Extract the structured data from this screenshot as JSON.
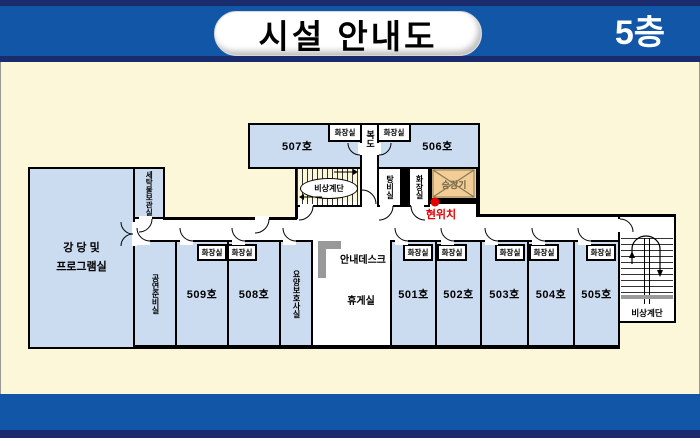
{
  "header": {
    "title": "시설 안내도",
    "floor": "5층"
  },
  "plan": {
    "labels": {
      "auditorium1": "강 당 및",
      "auditorium2": "프로그램실",
      "laundry": "세탁물보관실",
      "room507": "507호",
      "room506": "506호",
      "corridor": "복도",
      "toilet": "화장실",
      "stairs": "비상계단",
      "pantry": "탕비실",
      "elevator": "승강기",
      "current_location": "현위치",
      "prep": "공연준비실",
      "room509": "509호",
      "room508": "508호",
      "care": "요양보호사실",
      "infodesk": "안내데스크",
      "lounge": "휴게실",
      "room501": "501호",
      "room502": "502호",
      "room503": "503호",
      "room504": "504호",
      "room505": "505호"
    },
    "colors": {
      "header_blue": "#1156A7",
      "navy": "#1B2C6E",
      "cream": "#FBF7D8",
      "room_blue": "#CBDCF1",
      "elevator_tan": "#F2CD96",
      "marker_red": "#E60000",
      "desk_gray": "#999999"
    }
  }
}
